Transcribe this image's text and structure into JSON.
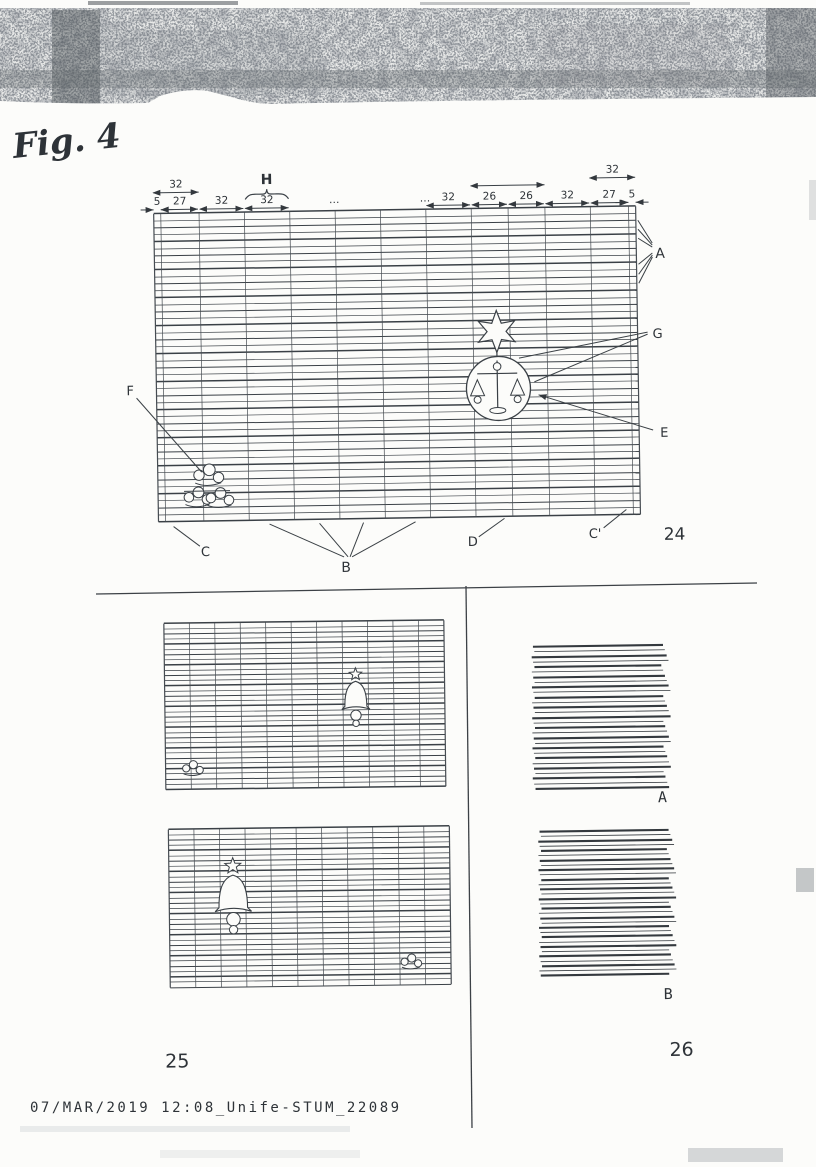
{
  "scan": {
    "fig_title": "Fig. 4",
    "footer": "07/MAR/2019 12:08_Unife-STUM_22089"
  },
  "fig24": {
    "number": "24",
    "labels": {
      "a": "A",
      "b": "B",
      "c": "C",
      "c_prime": "C'",
      "d": "D",
      "e": "E",
      "f": "F",
      "g": "G"
    },
    "brace": {
      "label": "H",
      "col": 3
    },
    "col_units": [
      5,
      27,
      32,
      32,
      32,
      32,
      32,
      32,
      26,
      26,
      32,
      27,
      5
    ],
    "dims_lower": [
      {
        "label": "5",
        "col": 0
      },
      {
        "label": "27",
        "col": 1
      },
      {
        "label": "32",
        "col": 2
      },
      {
        "label": "32",
        "col": 3
      },
      {
        "label": "…",
        "col": 4,
        "dots": true
      },
      {
        "label": "…",
        "col": 6,
        "dots": true
      },
      {
        "label": "32",
        "col": 7
      },
      {
        "label": "26",
        "col": 8
      },
      {
        "label": "26",
        "col": 9
      },
      {
        "label": "32",
        "col": 10
      },
      {
        "label": "27",
        "col": 11
      },
      {
        "label": "5",
        "col": 12
      }
    ],
    "dims_upper": [
      {
        "label": "32",
        "from": 0,
        "to": 2,
        "y": 189
      },
      {
        "label": "",
        "from": 8,
        "to": 10,
        "y": 187
      },
      {
        "label": "32",
        "from": 11,
        "to": 13,
        "y": 181
      }
    ],
    "rows": 44
  },
  "fig25": {
    "number": "25",
    "grid_top": {
      "rows": 32,
      "cols": 11
    },
    "grid_bottom": {
      "rows": 30,
      "cols": 11
    }
  },
  "fig26": {
    "number": "26",
    "label_a": "A",
    "label_b": "B",
    "lines_a": 29,
    "lines_b": 31
  }
}
